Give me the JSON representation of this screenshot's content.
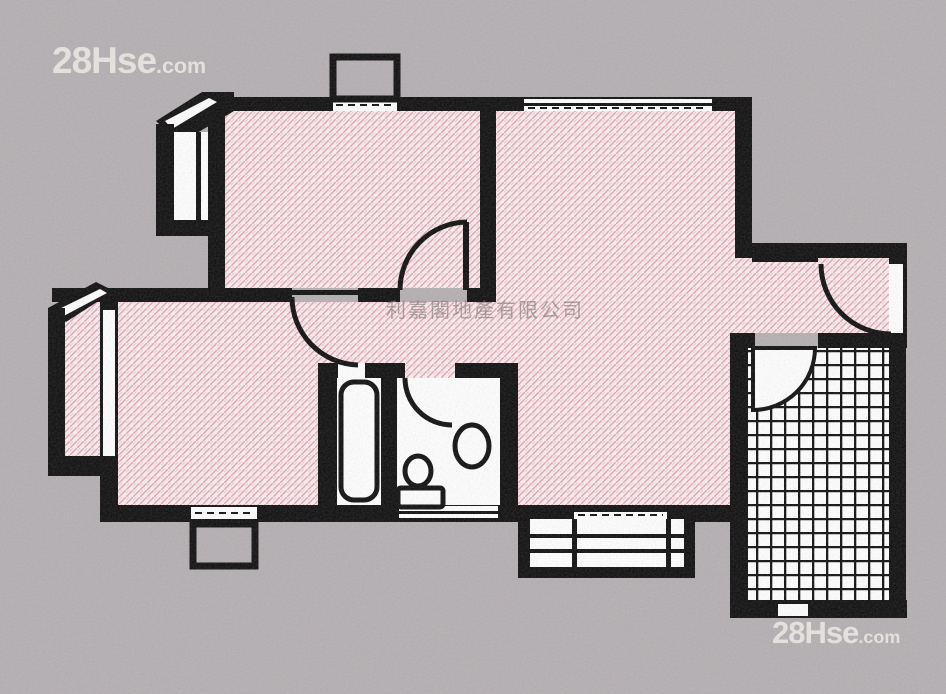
{
  "watermarks": {
    "top_left": {
      "brand": "28Hse",
      "tld": ".com"
    },
    "bottom_right": {
      "brand": "28Hse",
      "tld": ".com"
    },
    "center_company": "利嘉閣地產有限公司"
  },
  "colors": {
    "background": "#b4afb2",
    "wall": "#0d0c0d",
    "floor_pink_base": "#f9eff1",
    "floor_pink_hatch": "#e7a4b2",
    "room_white": "#ffffff",
    "watermark_white": "rgba(238,234,229,0.82)",
    "watermark_gray": "rgba(126,119,119,0.62)"
  }
}
